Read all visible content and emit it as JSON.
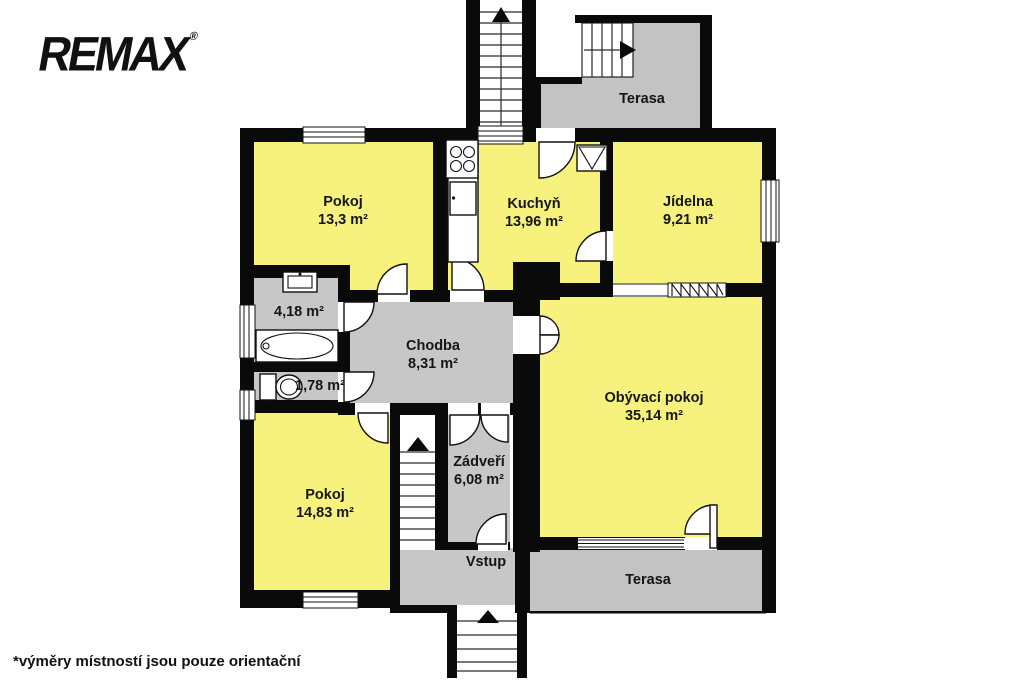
{
  "logo": {
    "brand": "REMAX",
    "mark": "®"
  },
  "disclaimer": "*výměry místností jsou pouze orientační",
  "rooms": {
    "pokoj1": {
      "name": "Pokoj",
      "area": "13,3 m²"
    },
    "kuchyn": {
      "name": "Kuchyň",
      "area": "13,96 m²"
    },
    "jidelna": {
      "name": "Jídelna",
      "area": "9,21 m²"
    },
    "koupelna": {
      "area": "4,18 m²"
    },
    "wc": {
      "area": "1,78 m²"
    },
    "chodba": {
      "name": "Chodba",
      "area": "8,31 m²"
    },
    "obyvaci_pokoj": {
      "name": "Obývací pokoj",
      "area": "35,14 m²"
    },
    "pokoj2": {
      "name": "Pokoj",
      "area": "14,83 m²"
    },
    "zadveri": {
      "name": "Zádveří",
      "area": "6,08 m²"
    },
    "vstup": {
      "name": "Vstup"
    },
    "terasa_horni": {
      "name": "Terasa"
    },
    "terasa_dolni": {
      "name": "Terasa"
    }
  },
  "colors": {
    "room": "#F6F27D",
    "service": "#C7C7C7",
    "terrace": "#C3C3C3",
    "wall": "#0A0A0A"
  }
}
